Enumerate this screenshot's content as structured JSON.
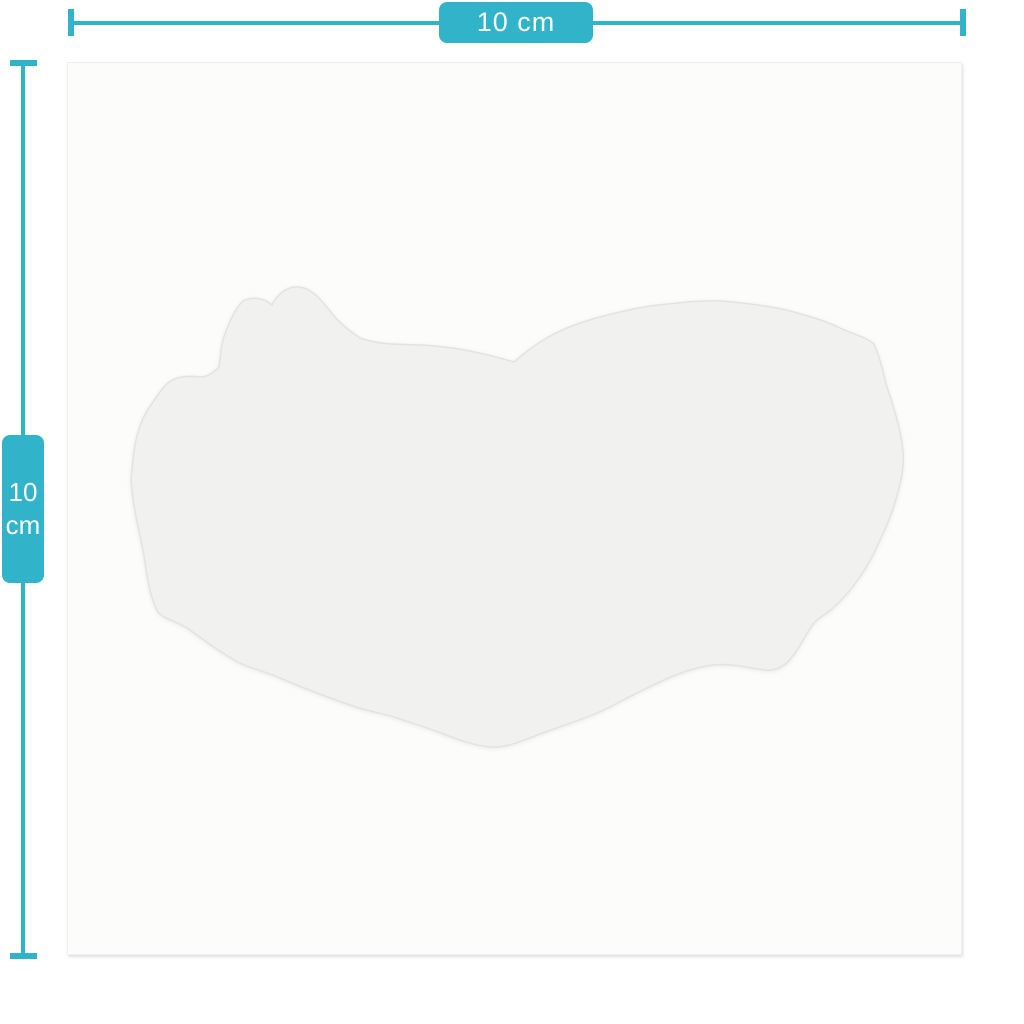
{
  "colors": {
    "accent_teal": "#31b3c9",
    "canvas_bg": "#fcfcfb",
    "canvas_edge": "#efefee",
    "sticker_fill": "#f1f1ef",
    "sticker_edge": "#e3e3e1",
    "badge_text": "#ffffff"
  },
  "dimensions": {
    "width": {
      "label": "10 cm",
      "value": "10",
      "unit": "cm"
    },
    "height": {
      "value": "10",
      "unit": "cm"
    }
  }
}
